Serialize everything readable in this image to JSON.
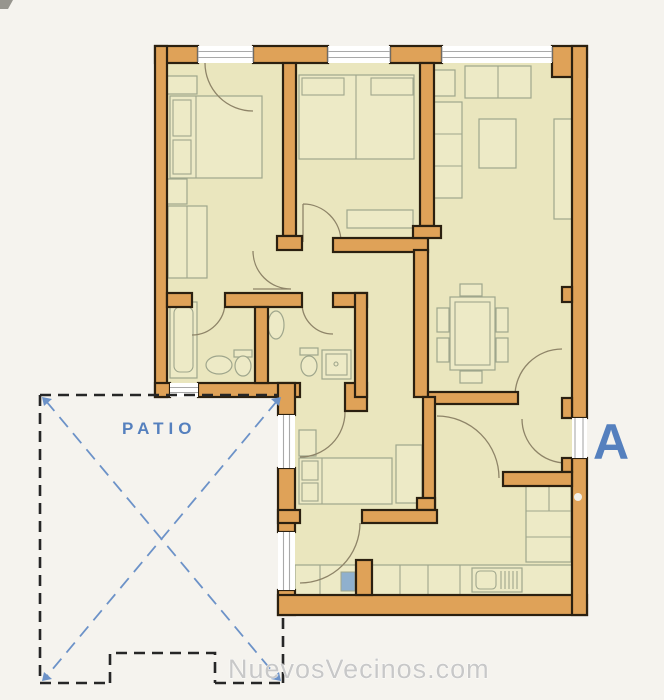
{
  "labels": {
    "patio": "PATIO",
    "unit": "A"
  },
  "watermark": {
    "text": "NuevosVecinos.com"
  },
  "colors": {
    "page-bg": "#F5F3EE",
    "wall": "#DFA258",
    "wall-outline": "#2B2010",
    "floor": "#EAE6BE",
    "floor-light": "#EDEAC6",
    "furniture": "#9FA68C",
    "door-arc": "#8E8468",
    "window-line": "#A9A9A9",
    "accent": "#5580BE",
    "patio-line": "#6C92C8",
    "patio-border": "#262626",
    "watermark": "#C8C8C8",
    "hob": "#8FB0CE"
  }
}
